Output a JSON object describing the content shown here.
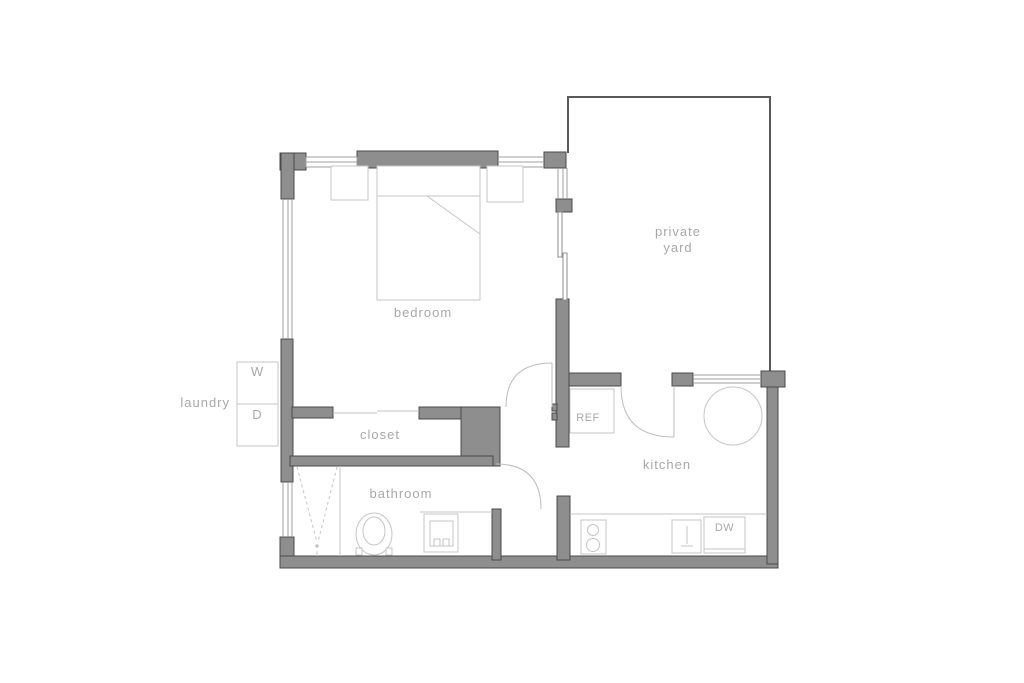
{
  "colors": {
    "background": "#ffffff",
    "wall_fill": "#8e8e8e",
    "wall_stroke": "#4a4a4a",
    "window_line": "#9f9f9f",
    "fixture_line": "#c5c5c5",
    "door_line": "#bdbdbd",
    "yard_outline": "#5a5a5a",
    "label_text": "#a8a8a8"
  },
  "rooms": {
    "bedroom": {
      "label": "bedroom"
    },
    "private_yard": {
      "label_line1": "private",
      "label_line2": "yard"
    },
    "laundry": {
      "label": "laundry",
      "washer": "W",
      "dryer": "D"
    },
    "closet": {
      "label": "closet"
    },
    "bathroom": {
      "label": "bathroom"
    },
    "kitchen": {
      "label": "kitchen",
      "refrigerator": "REF",
      "dishwasher": "DW"
    }
  }
}
